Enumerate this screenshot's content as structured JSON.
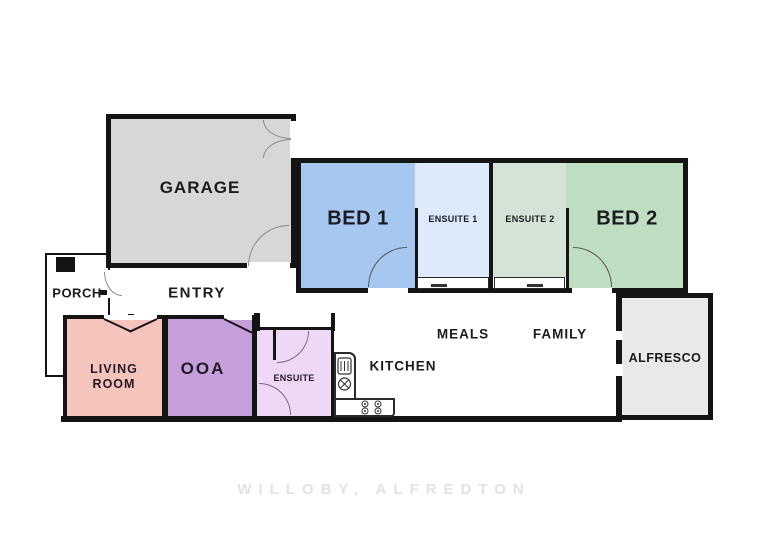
{
  "plan": {
    "rooms": {
      "garage": {
        "label": "GARAGE",
        "color": "#d7d7d7"
      },
      "bed1": {
        "label": "BED 1",
        "color": "#a6c7f0"
      },
      "ensuite1": {
        "label": "ENSUITE 1",
        "color": "#dceafb"
      },
      "ensuite2": {
        "label": "ENSUITE 2",
        "color": "#d5e3d6"
      },
      "bed2": {
        "label": "BED 2",
        "color": "#bfddc1"
      },
      "porch": {
        "label": "PORCH",
        "color": "#ffffff"
      },
      "entry": {
        "label": "ENTRY"
      },
      "living_room": {
        "label": "LIVING ROOM",
        "color": "#f4c4bd"
      },
      "ooa": {
        "label": "OOA",
        "color": "#c59fdc"
      },
      "ensuite": {
        "label": "ENSUITE",
        "color": "#eed8f6"
      },
      "kitchen": {
        "label": "KITCHEN"
      },
      "meals": {
        "label": "MEALS"
      },
      "family": {
        "label": "FAMILY"
      },
      "alfresco": {
        "label": "ALFRESCO",
        "color": "#e9e9e9"
      }
    },
    "wall_color": "#141414",
    "footer": {
      "text": "WILLOBY, ALFREDTON",
      "color": "#e2e2e2"
    }
  }
}
